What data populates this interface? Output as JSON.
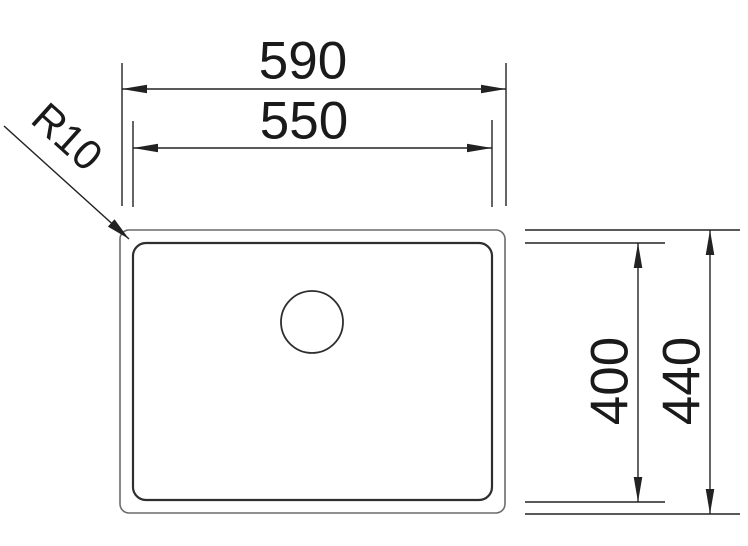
{
  "diagram": {
    "type": "technical-drawing",
    "subject": "rectangular-sink-top-view",
    "colors": {
      "background": "#ffffff",
      "outline_outer": "#6b6b6b",
      "outline_inner": "#2e2e2e",
      "dimension_line": "#222222",
      "text": "#1a1a1a"
    },
    "dimensions": {
      "outer_width": {
        "label": "590"
      },
      "inner_width": {
        "label": "550"
      },
      "inner_depth": {
        "label": "400"
      },
      "outer_depth": {
        "label": "440"
      },
      "corner_radius": {
        "label": "R10"
      }
    }
  }
}
